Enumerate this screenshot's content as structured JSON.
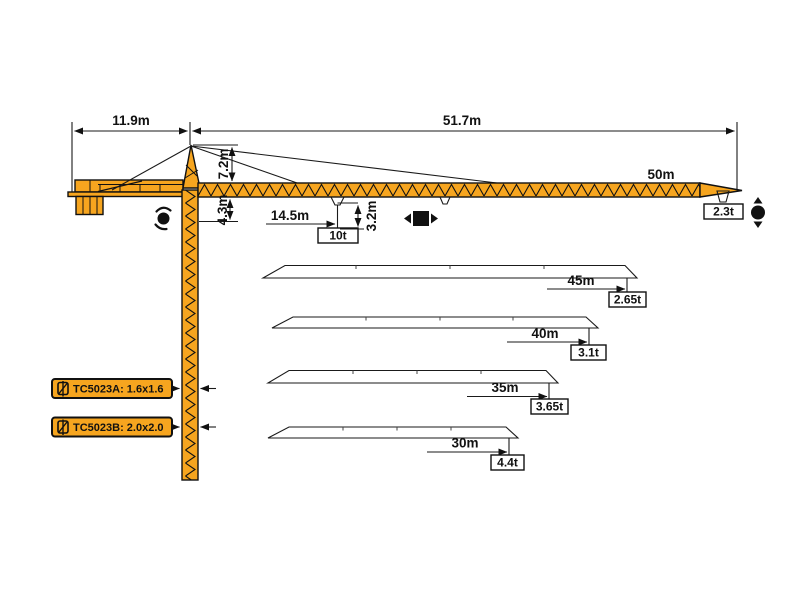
{
  "diagram": {
    "type": "tower-crane-specification-diagram",
    "colors": {
      "crane_yellow": "#F6A51F",
      "outline": "#111111",
      "background": "#FFFFFF"
    },
    "top_dims": {
      "counter_jib": "11.9m",
      "main_jib": "51.7m"
    },
    "vertical_dims": {
      "head": "7.2m",
      "under_jib": "4.3m",
      "hook": "3.2m"
    },
    "load_point": {
      "radius": "14.5m",
      "capacity": "10t"
    },
    "main_jib": {
      "length": "50m",
      "tip_capacity": "2.3t"
    },
    "variants": [
      {
        "length": "45m",
        "tip_capacity": "2.65t"
      },
      {
        "length": "40m",
        "tip_capacity": "3.1t"
      },
      {
        "length": "35m",
        "tip_capacity": "3.65t"
      },
      {
        "length": "30m",
        "tip_capacity": "4.4t"
      }
    ],
    "models": [
      {
        "label": "TC5023A: 1.6x1.6"
      },
      {
        "label": "TC5023B: 2.0x2.0"
      }
    ],
    "symbols": [
      "slewing-icon",
      "trolley-travel-icon",
      "hoist-icon",
      "mast-section-icon"
    ]
  }
}
